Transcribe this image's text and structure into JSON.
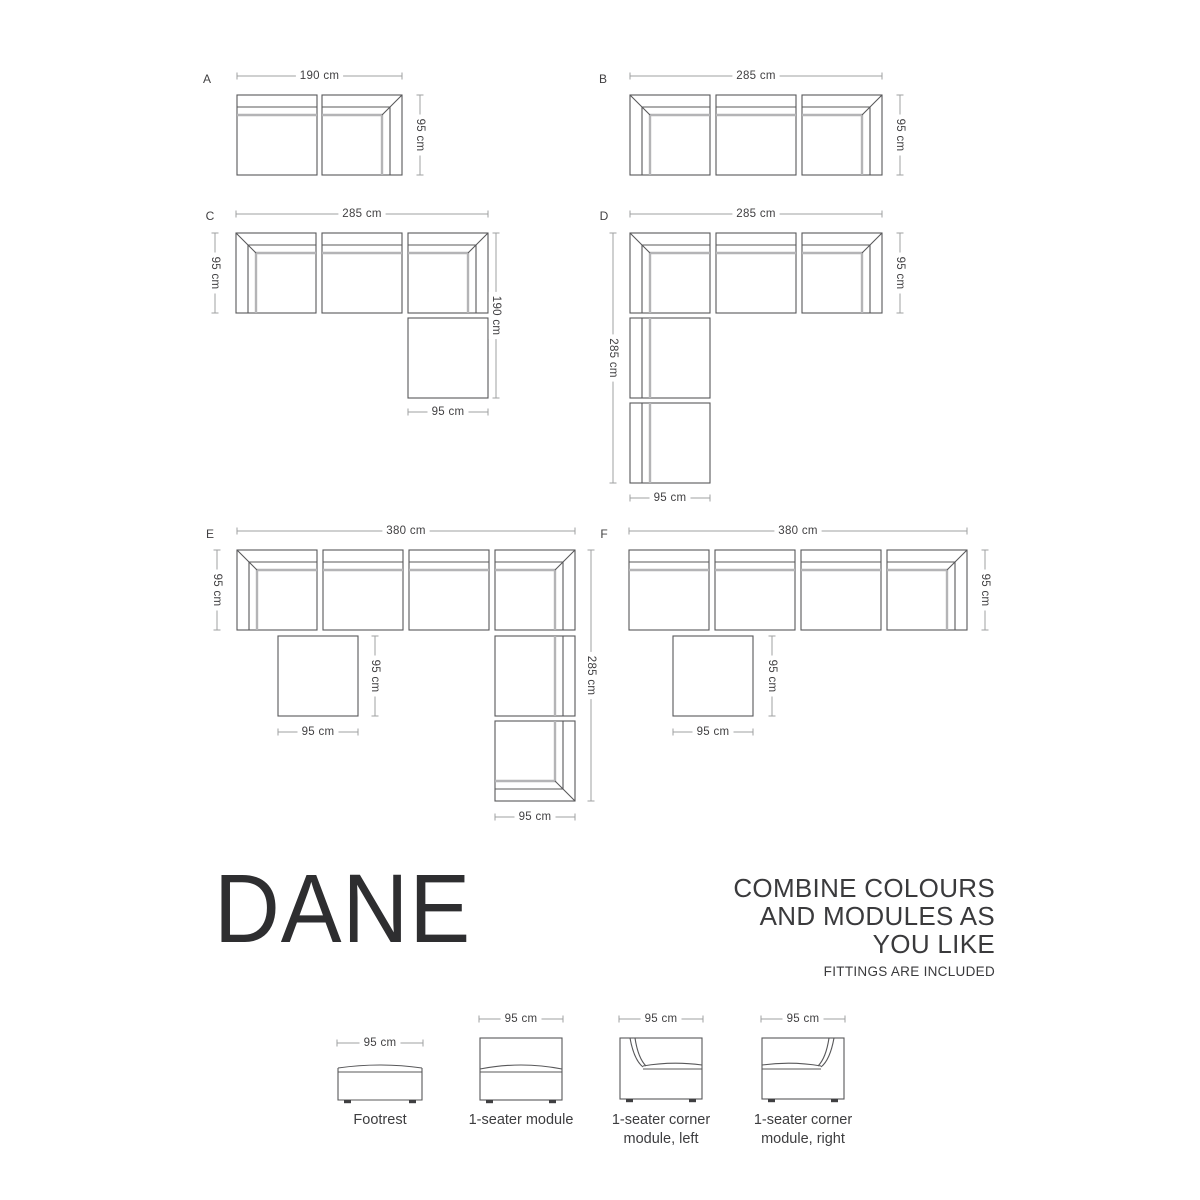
{
  "title": {
    "text": "DANE"
  },
  "tagline": {
    "lines": [
      "COMBINE COLOURS",
      "AND MODULES AS",
      "YOU LIKE"
    ],
    "note": "FITTINGS ARE INCLUDED"
  },
  "colors": {
    "line_dark": "#58585a",
    "line_gray": "#b4b4b6",
    "dim_line": "#9fa0a2",
    "text": "#414042",
    "feet": "#3f3f41",
    "background": "#ffffff"
  },
  "diagram": {
    "configs": [
      {
        "label": "A",
        "label_pos": [
          207,
          79
        ],
        "modules": [
          {
            "type": "seater",
            "back": "top",
            "x": 237,
            "y": 95,
            "w": 80,
            "h": 80
          },
          {
            "type": "corner",
            "corner": "top-right",
            "x": 322,
            "y": 95,
            "w": 80,
            "h": 80
          }
        ],
        "dims": [
          {
            "dir": "h",
            "label": "190 cm",
            "x1": 237,
            "x2": 402,
            "y": 76
          },
          {
            "dir": "v",
            "label": "95 cm",
            "x": 420,
            "y1": 95,
            "y2": 175
          }
        ]
      },
      {
        "label": "B",
        "label_pos": [
          603,
          79
        ],
        "modules": [
          {
            "type": "corner",
            "corner": "top-left",
            "x": 630,
            "y": 95,
            "w": 80,
            "h": 80
          },
          {
            "type": "seater",
            "back": "top",
            "x": 716,
            "y": 95,
            "w": 80,
            "h": 80
          },
          {
            "type": "corner",
            "corner": "top-right",
            "x": 802,
            "y": 95,
            "w": 80,
            "h": 80
          }
        ],
        "dims": [
          {
            "dir": "h",
            "label": "285 cm",
            "x1": 630,
            "x2": 882,
            "y": 76
          },
          {
            "dir": "v",
            "label": "95 cm",
            "x": 900,
            "y1": 95,
            "y2": 175
          }
        ]
      },
      {
        "label": "C",
        "label_pos": [
          210,
          216
        ],
        "modules": [
          {
            "type": "corner",
            "corner": "top-left",
            "x": 236,
            "y": 233,
            "w": 80,
            "h": 80
          },
          {
            "type": "seater",
            "back": "top",
            "x": 322,
            "y": 233,
            "w": 80,
            "h": 80
          },
          {
            "type": "corner",
            "corner": "top-right",
            "x": 408,
            "y": 233,
            "w": 80,
            "h": 80
          },
          {
            "type": "footrest",
            "x": 408,
            "y": 318,
            "w": 80,
            "h": 80
          }
        ],
        "dims": [
          {
            "dir": "h",
            "label": "285 cm",
            "x1": 236,
            "x2": 488,
            "y": 214
          },
          {
            "dir": "v",
            "label": "95 cm",
            "x": 215,
            "y1": 233,
            "y2": 313
          },
          {
            "dir": "v",
            "label": "190 cm",
            "x": 496,
            "y1": 233,
            "y2": 398
          },
          {
            "dir": "h",
            "label": "95 cm",
            "x1": 408,
            "x2": 488,
            "y": 412
          }
        ]
      },
      {
        "label": "D",
        "label_pos": [
          604,
          216
        ],
        "modules": [
          {
            "type": "corner",
            "corner": "top-left",
            "x": 630,
            "y": 233,
            "w": 80,
            "h": 80
          },
          {
            "type": "seater",
            "back": "top",
            "x": 716,
            "y": 233,
            "w": 80,
            "h": 80
          },
          {
            "type": "corner",
            "corner": "top-right",
            "x": 802,
            "y": 233,
            "w": 80,
            "h": 80
          },
          {
            "type": "seater",
            "back": "left",
            "x": 630,
            "y": 318,
            "w": 80,
            "h": 80
          },
          {
            "type": "seater",
            "back": "left",
            "x": 630,
            "y": 403,
            "w": 80,
            "h": 80
          }
        ],
        "dims": [
          {
            "dir": "h",
            "label": "285 cm",
            "x1": 630,
            "x2": 882,
            "y": 214
          },
          {
            "dir": "v",
            "label": "95 cm",
            "x": 900,
            "y1": 233,
            "y2": 313
          },
          {
            "dir": "v",
            "label": "285 cm",
            "x": 613,
            "y1": 233,
            "y2": 483
          },
          {
            "dir": "h",
            "label": "95 cm",
            "x1": 630,
            "x2": 710,
            "y": 498
          }
        ]
      },
      {
        "label": "E",
        "label_pos": [
          210,
          534
        ],
        "modules": [
          {
            "type": "corner",
            "corner": "top-left",
            "x": 237,
            "y": 550,
            "w": 80,
            "h": 80
          },
          {
            "type": "seater",
            "back": "top",
            "x": 323,
            "y": 550,
            "w": 80,
            "h": 80
          },
          {
            "type": "seater",
            "back": "top",
            "x": 409,
            "y": 550,
            "w": 80,
            "h": 80
          },
          {
            "type": "corner",
            "corner": "top-right",
            "x": 495,
            "y": 550,
            "w": 80,
            "h": 80
          },
          {
            "type": "footrest",
            "x": 278,
            "y": 636,
            "w": 80,
            "h": 80
          },
          {
            "type": "seater",
            "back": "right",
            "x": 495,
            "y": 636,
            "w": 80,
            "h": 80
          },
          {
            "type": "corner",
            "corner": "bottom-right",
            "x": 495,
            "y": 721,
            "w": 80,
            "h": 80
          }
        ],
        "dims": [
          {
            "dir": "h",
            "label": "380 cm",
            "x1": 237,
            "x2": 575,
            "y": 531
          },
          {
            "dir": "v",
            "label": "95 cm",
            "x": 217,
            "y1": 550,
            "y2": 630
          },
          {
            "dir": "v",
            "label": "285 cm",
            "x": 591,
            "y1": 550,
            "y2": 801
          },
          {
            "dir": "v",
            "label": "95 cm",
            "x": 375,
            "y1": 636,
            "y2": 716
          },
          {
            "dir": "h",
            "label": "95 cm",
            "x1": 278,
            "x2": 358,
            "y": 732
          },
          {
            "dir": "h",
            "label": "95 cm",
            "x1": 495,
            "x2": 575,
            "y": 817
          }
        ]
      },
      {
        "label": "F",
        "label_pos": [
          604,
          534
        ],
        "modules": [
          {
            "type": "seater",
            "back": "top",
            "x": 629,
            "y": 550,
            "w": 80,
            "h": 80
          },
          {
            "type": "seater",
            "back": "top",
            "x": 715,
            "y": 550,
            "w": 80,
            "h": 80
          },
          {
            "type": "seater",
            "back": "top",
            "x": 801,
            "y": 550,
            "w": 80,
            "h": 80
          },
          {
            "type": "corner",
            "corner": "top-right",
            "x": 887,
            "y": 550,
            "w": 80,
            "h": 80
          },
          {
            "type": "footrest",
            "x": 673,
            "y": 636,
            "w": 80,
            "h": 80
          }
        ],
        "dims": [
          {
            "dir": "h",
            "label": "380 cm",
            "x1": 629,
            "x2": 967,
            "y": 531
          },
          {
            "dir": "v",
            "label": "95 cm",
            "x": 985,
            "y1": 550,
            "y2": 630
          },
          {
            "dir": "v",
            "label": "95 cm",
            "x": 772,
            "y1": 636,
            "y2": 716
          },
          {
            "dir": "h",
            "label": "95 cm",
            "x1": 673,
            "x2": 753,
            "y": 732
          }
        ]
      }
    ],
    "legend": {
      "items": [
        {
          "type": "footrest",
          "dim_label": "95 cm",
          "dim": [
            337,
            423,
            1043
          ],
          "box": [
            338,
            1065,
            84,
            35
          ],
          "label_lines": [
            "Footrest"
          ],
          "label_cx": 380,
          "label_y": 1124
        },
        {
          "type": "seater",
          "dim_label": "95 cm",
          "dim": [
            479,
            563,
            1019
          ],
          "box": [
            480,
            1038,
            82,
            62
          ],
          "label_lines": [
            "1-seater module"
          ],
          "label_cx": 521,
          "label_y": 1124
        },
        {
          "type": "corner-left",
          "dim_label": "95 cm",
          "dim": [
            619,
            703,
            1019
          ],
          "box": [
            620,
            1038,
            82,
            61
          ],
          "label_lines": [
            "1-seater corner",
            "module, left"
          ],
          "label_cx": 661,
          "label_y": 1124
        },
        {
          "type": "corner-right",
          "dim_label": "95 cm",
          "dim": [
            761,
            845,
            1019
          ],
          "box": [
            762,
            1038,
            82,
            61
          ],
          "label_lines": [
            "1-seater corner",
            "module, right"
          ],
          "label_cx": 803,
          "label_y": 1124
        }
      ]
    }
  }
}
